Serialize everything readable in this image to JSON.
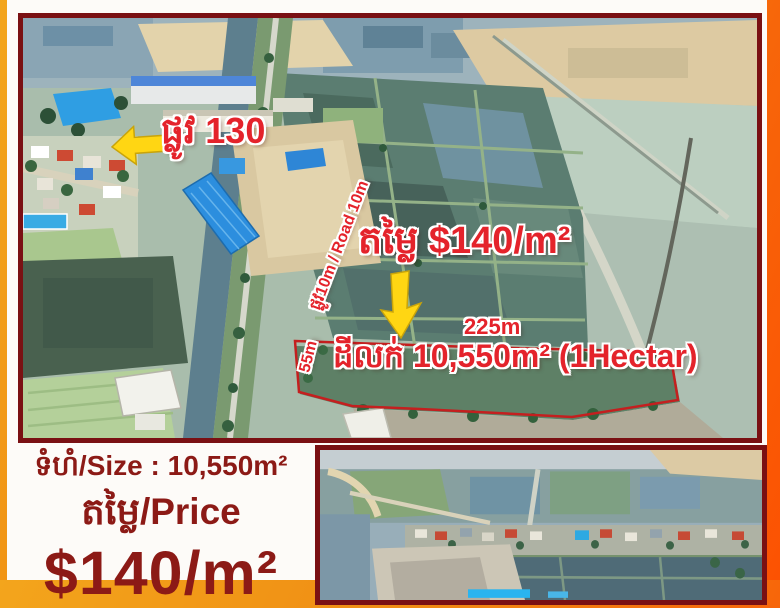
{
  "main_photo": {
    "road_sign": "ផ្លូវ 130",
    "road_label": "ផ្លូវ10m / Road 10m",
    "price_overlay": "តម្លៃ $140/m²",
    "width_label": "225m",
    "depth_label": "55m",
    "sale_overlay": "ដីលក់ 10,550m² (1Hectar)"
  },
  "info_panel": {
    "size_line": "ទំហំ/Size : 10,550m²",
    "price_label": "តម្លៃ/Price",
    "price_value": "$140/m²"
  },
  "icons": {
    "left_arrow": "left-arrow-icon",
    "down_arrow": "down-arrow-icon"
  },
  "colors": {
    "overlay_red": "#e4232b",
    "plot_outline_red": "#c41f1f",
    "maroon_text": "#8c1a16",
    "photo_border": "#7a1013",
    "arrow_yellow": "#ffd613",
    "frame_gold": "#f3a51c",
    "frame_orange": "#fc5202",
    "panel_white": "#fdfbf8"
  }
}
